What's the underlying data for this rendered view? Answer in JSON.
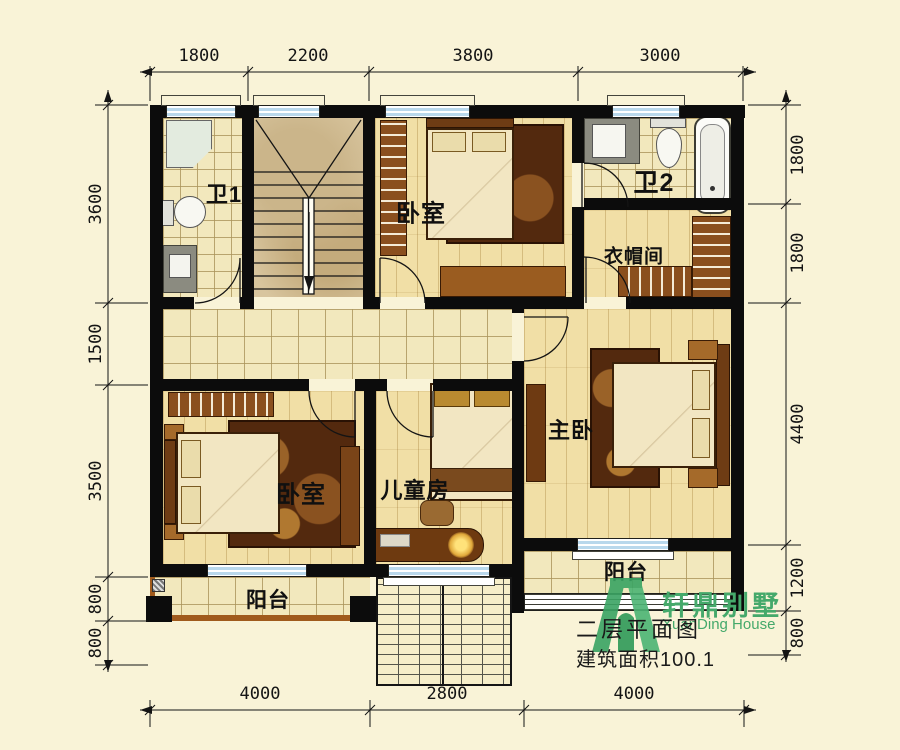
{
  "dims": {
    "top": [
      "1800",
      "2200",
      "3800",
      "3000"
    ],
    "left": [
      "3600",
      "1500",
      "3500",
      "800",
      "800"
    ],
    "right": [
      "1800",
      "1800",
      "4400",
      "1200",
      "800"
    ],
    "bottom": [
      "4000",
      "2800",
      "4000"
    ]
  },
  "rooms": {
    "bath1": {
      "label": "卫1"
    },
    "bedroom_top": {
      "label": "卧室"
    },
    "bath2": {
      "label": "卫2"
    },
    "cloakroom": {
      "label": "衣帽间"
    },
    "bedroom_left": {
      "label": "卧室"
    },
    "kids": {
      "label": "儿童房"
    },
    "master": {
      "label": "主卧"
    },
    "balcony_left": {
      "label": "阳台"
    },
    "balcony_right": {
      "label": "阳台"
    }
  },
  "titleblock": {
    "plan_title": "二层平面图",
    "area_text": "建筑面积100.1",
    "brand_cn": "轩鼎别墅",
    "brand_en": "XuanDing House"
  },
  "colors": {
    "brand_green": "#45a96b",
    "wall_black": "#0c0c0c",
    "background": "#f9f3d7"
  }
}
